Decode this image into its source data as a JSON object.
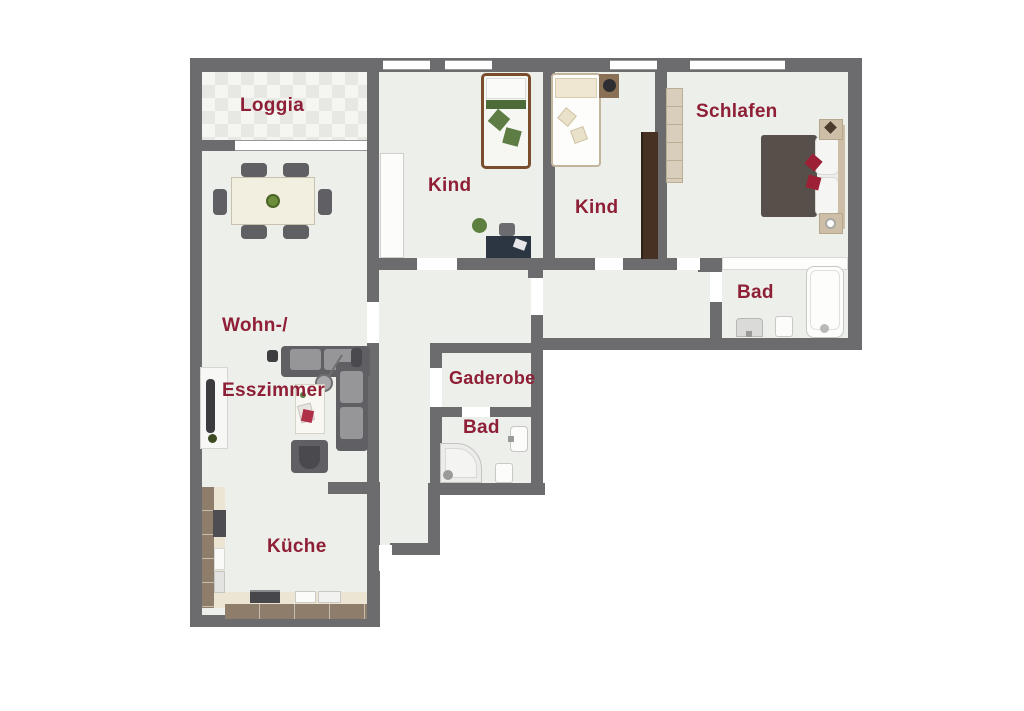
{
  "rooms": {
    "loggia": {
      "label": "Loggia"
    },
    "kind1": {
      "label": "Kind"
    },
    "kind2": {
      "label": "Kind"
    },
    "schlafen": {
      "label": "Schlafen"
    },
    "bad_top": {
      "label": "Bad"
    },
    "wohn": {
      "label_line1": "Wohn-/",
      "label_line2": "Esszimmer"
    },
    "gaderobe": {
      "label": "Gaderobe"
    },
    "bad_small": {
      "label": "Bad"
    },
    "kueche": {
      "label": "Küche"
    }
  },
  "colors": {
    "wall": "#6c6c6f",
    "floor": "#edefea",
    "label": "#8e1f36",
    "background": "#ffffff"
  }
}
